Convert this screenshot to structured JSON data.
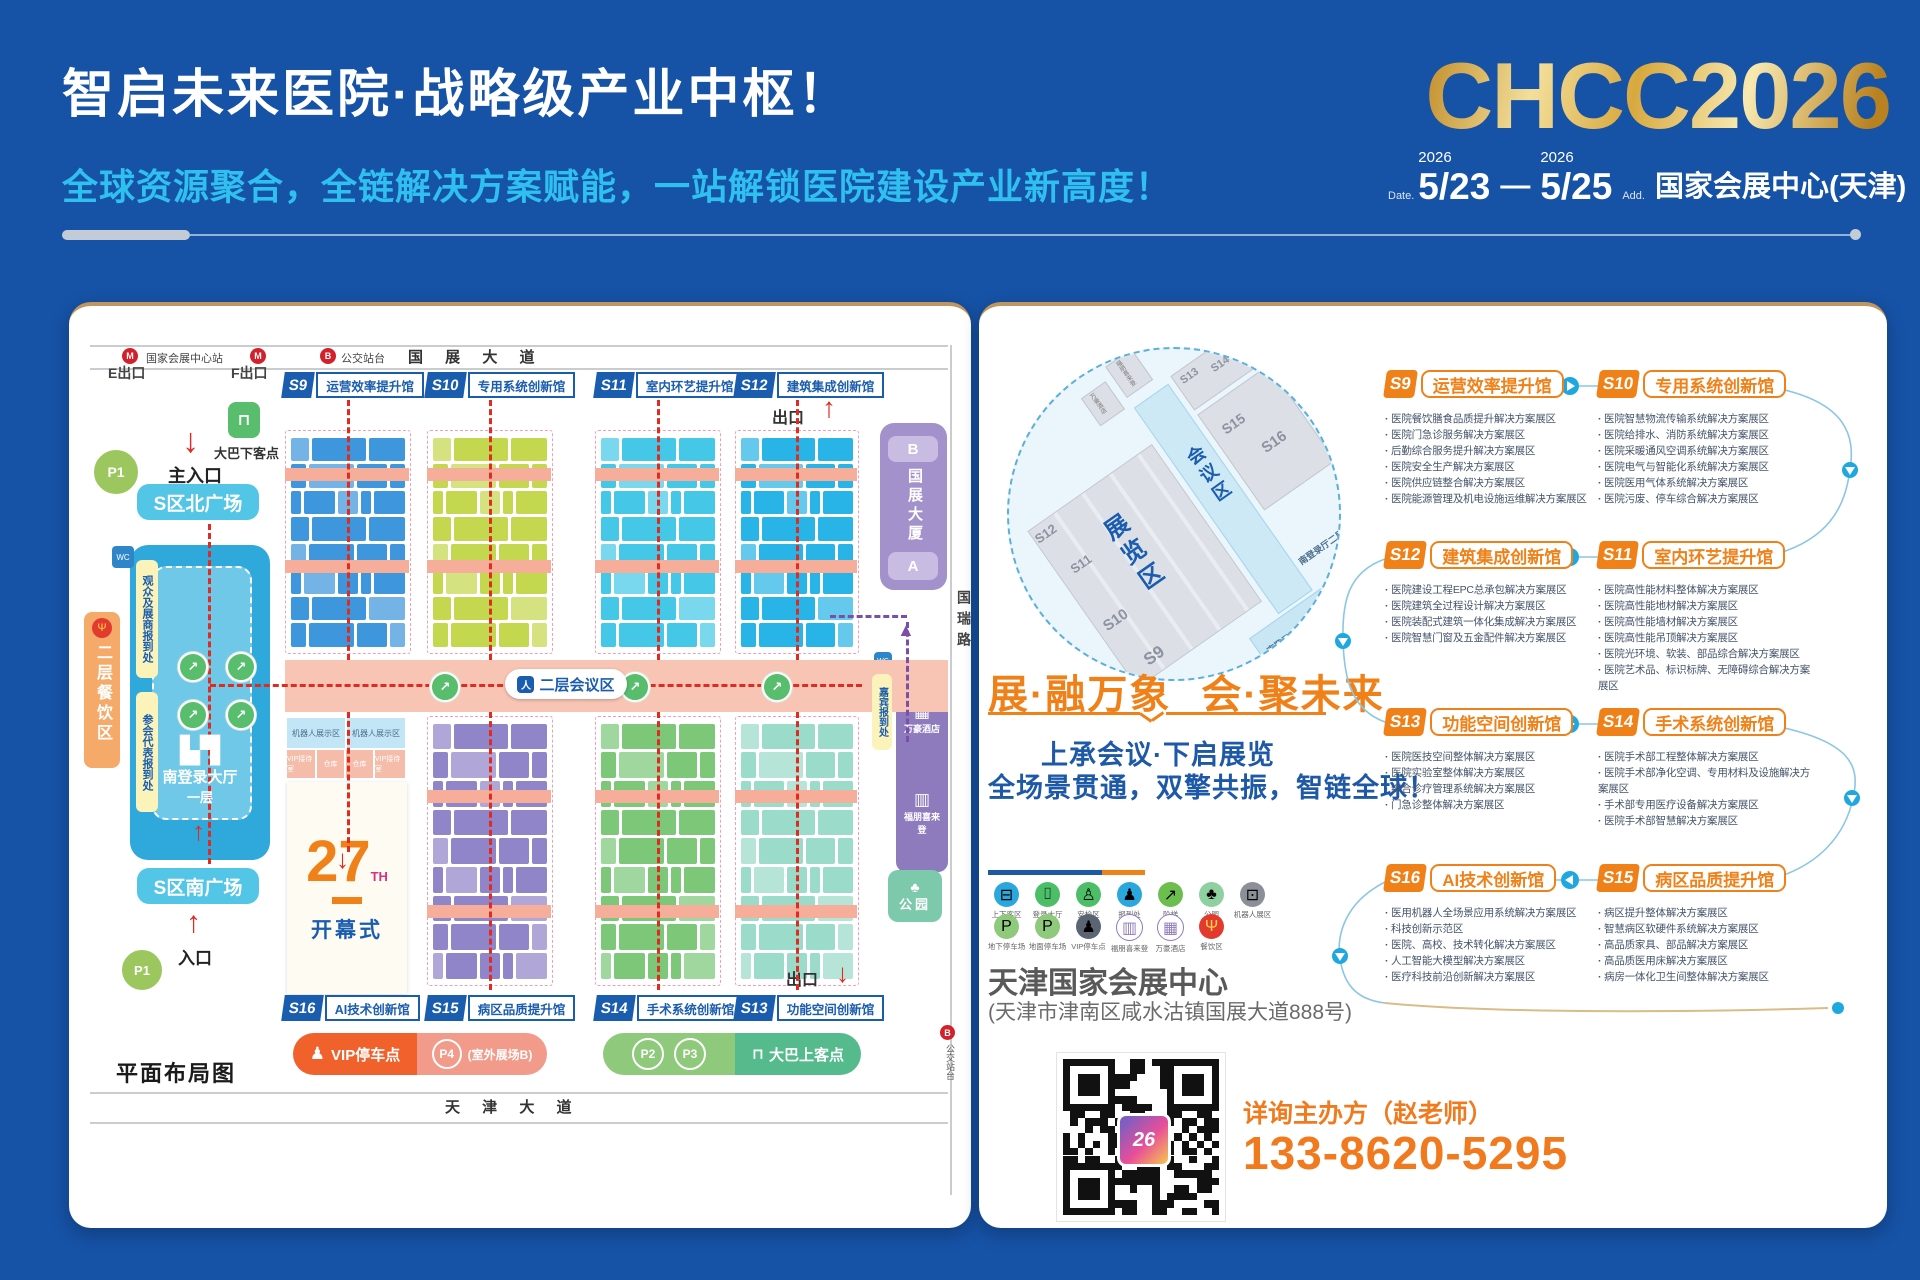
{
  "palette": {
    "bg_blue": "#1652A6",
    "cyan": "#2FC0F0",
    "gold": "#D8A83E",
    "accent_orange": "#F08119",
    "brand_blue": "#1A5CAE",
    "bullet_text": "#44546A",
    "red_route": "#E02B20"
  },
  "header": {
    "title": "智启未来医院·战略级产业中枢！",
    "subtitle": "全球资源聚合，全链解决方案赋能，一站解锁医院建设产业新高度！",
    "logo": "CHCC2026",
    "date_label": "Date.",
    "year_from": "2026",
    "date_from": "5/23",
    "date_sep": "—",
    "year_to": "2026",
    "date_to": "5/25",
    "addr_label": "Add.",
    "venue_short": "国家会展中心(天津)"
  },
  "map": {
    "plan_title": "平面布局图",
    "road_top": "国 展 大 道",
    "road_bottom": "天 津 大 道",
    "road_right": "国瑞路",
    "metro_station": "国家会展中心站",
    "exit_e": "E出口",
    "exit_f": "F出口",
    "bus_stop_top": "公交站台",
    "bus_stop_right": "公交站台",
    "halls_top": [
      {
        "code": "S9",
        "name": "运营效率提升馆"
      },
      {
        "code": "S10",
        "name": "专用系统创新馆"
      },
      {
        "code": "S11",
        "name": "室内环艺提升馆"
      },
      {
        "code": "S12",
        "name": "建筑集成创新馆"
      }
    ],
    "halls_bottom": [
      {
        "code": "S16",
        "name": "AI技术创新馆"
      },
      {
        "code": "S15",
        "name": "病区品质提升馆"
      },
      {
        "code": "S14",
        "name": "手术系统创新馆"
      },
      {
        "code": "S13",
        "name": "功能空间创新馆"
      }
    ],
    "exit_top": "出口",
    "exit_bottom": "出口",
    "main_entrance": "主入口",
    "entrance": "入口",
    "north_plaza": "S区北广场",
    "south_plaza": "S区南广场",
    "bus_drop": "大巴下客点",
    "p1": "P1",
    "dining_area": "二层餐饮区",
    "checkin_visitors": "观众及展商报到处",
    "checkin_delegates": "参会代表报到处",
    "south_hall_name": "南登录大厅",
    "south_hall_floor": "一层",
    "conference_area": "二层会议区",
    "room_robot": "机器人展示区",
    "room_vip": "VIP接待室",
    "room_warehouse": "仓库",
    "opening_num": "27",
    "opening_th": "TH",
    "opening_label": "开幕式",
    "tower_b": "B",
    "tower_name": "国展大厦",
    "tower_a": "A",
    "guest_checkin": "嘉宾报到处",
    "hotel_marriott": "万豪酒店",
    "hotel_sheraton": "福朋喜来登",
    "park": "公园",
    "legend_vip": "VIP停车点",
    "legend_p4": "P4",
    "legend_p4_note": "(室外展场B)",
    "legend_p2": "P2",
    "legend_p3": "P3",
    "legend_bus_pickup": "大巴上客点"
  },
  "panel": {
    "circle_labels": {
      "exhibition": "展览区",
      "conference": "会议区",
      "s9": "S9",
      "s10": "S10",
      "s11": "S11",
      "s12": "S12",
      "s13": "S13",
      "s14": "S14",
      "s15": "S15",
      "s16": "S16",
      "south_hall_l1": "南登录厅一层",
      "south_hall_l2": "南登录厅二层",
      "main_entrance": "主入口",
      "dining": "餐饮区",
      "hotel_marriott": "万豪酒店",
      "hotel_sheraton": "福朋喜来登"
    },
    "slogan_left": "展·融万象",
    "slogan_right": "会·聚未来",
    "tagline1": "上承会议·下启展览",
    "tagline2": "全场景贯通，双擎共振，智链全球！",
    "icon_legend_row1": [
      "上下客区",
      "登录大厅",
      "安检区",
      "报到处",
      "阶梯",
      "公园",
      "机器人展区"
    ],
    "icon_legend_row2": [
      "地下停车场",
      "地面停车场",
      "VIP停车点",
      "福朋喜来登",
      "万豪酒店",
      "餐饮区"
    ],
    "venue_name": "天津国家会展中心",
    "venue_address": "(天津市津南区咸水沽镇国展大道888号)",
    "contact_label": "详询主办方（赵老师）",
    "phone": "133-8620-5295",
    "qr_logo": "26",
    "sections": [
      {
        "code": "S9",
        "name": "运营效率提升馆",
        "items": [
          "医院餐饮膳食品质提升解决方案展区",
          "医院门急诊服务解决方案展区",
          "后勤综合服务提升解决方案展区",
          "医院安全生产解决方案展区",
          "医院供应链整合解决方案展区",
          "医院能源管理及机电设施运维解决方案展区"
        ]
      },
      {
        "code": "S10",
        "name": "专用系统创新馆",
        "items": [
          "医院智慧物流传输系统解决方案展区",
          "医院给排水、消防系统解决方案展区",
          "医院采暖通风空调系统解决方案展区",
          "医院电气与智能化系统解决方案展区",
          "医院医用气体系统解决方案展区",
          "医院污废、停车综合解决方案展区"
        ]
      },
      {
        "code": "S12",
        "name": "建筑集成创新馆",
        "items": [
          "医院建设工程EPC总承包解决方案展区",
          "医院建筑全过程设计解决方案展区",
          "医院装配式建筑一体化集成解决方案展区",
          "医院智慧门窗及五金配件解决方案展区"
        ]
      },
      {
        "code": "S11",
        "name": "室内环艺提升馆",
        "items": [
          "医院高性能材料整体解决方案展区",
          "医院高性能地材解决方案展区",
          "医院高性能墙材解决方案展区",
          "医院高性能吊顶解决方案展区",
          "医院光环境、软装、部品综合解决方案展区",
          "医院艺术品、标识标牌、无障碍综合解决方案展区"
        ]
      },
      {
        "code": "S13",
        "name": "功能空间创新馆",
        "items": [
          "医院医技空间整体解决方案展区",
          "医院实验室整体解决方案展区",
          "综合诊疗管理系统解决方案展区",
          "门急诊整体解决方案展区"
        ]
      },
      {
        "code": "S14",
        "name": "手术系统创新馆",
        "items": [
          "医院手术部工程整体解决方案展区",
          "医院手术部净化空调、专用材料及设施解决方案展区",
          "手术部专用医疗设备解决方案展区",
          "医院手术部智慧解决方案展区"
        ]
      },
      {
        "code": "S16",
        "name": "AI技术创新馆",
        "items": [
          "医用机器人全场景应用系统解决方案展区",
          "科技创新示范区",
          "医院、高校、技术转化解决方案展区",
          "人工智能大模型解决方案展区",
          "医疗科技前沿创新解决方案展区"
        ]
      },
      {
        "code": "S15",
        "name": "病区品质提升馆",
        "items": [
          "病区提升整体解决方案展区",
          "智慧病区软硬件系统解决方案展区",
          "高品质家具、部品解决方案展区",
          "高品质医用床解决方案展区",
          "病房一体化卫生间整体解决方案展区"
        ]
      }
    ]
  }
}
